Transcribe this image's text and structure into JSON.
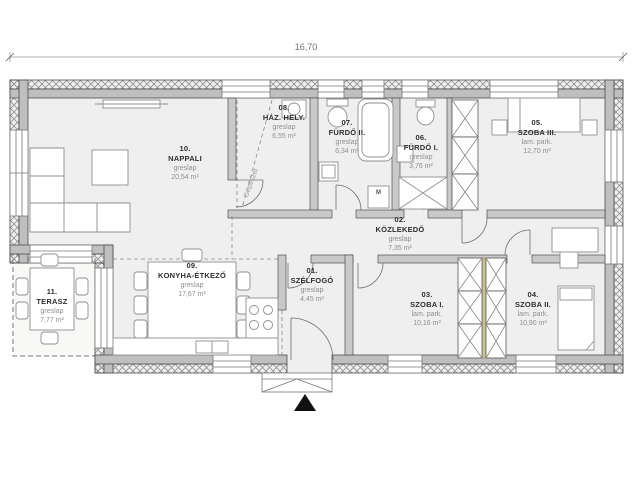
{
  "dimensions": {
    "total_width": "16,70"
  },
  "annotations": {
    "mechanical": "Gépészet",
    "washing_machine": "M"
  },
  "rooms": [
    {
      "number": "01.",
      "name": "SZÉLFOGÓ",
      "material": "greslap",
      "area": "4,45 m²"
    },
    {
      "number": "02.",
      "name": "KÖZLEKEDŐ",
      "material": "greslap",
      "area": "7,35 m²"
    },
    {
      "number": "03.",
      "name": "SZOBA I.",
      "material": "lam. park.",
      "area": "10,16 m²"
    },
    {
      "number": "04.",
      "name": "SZOBA II.",
      "material": "lam. park.",
      "area": "10,90 m²"
    },
    {
      "number": "05.",
      "name": "SZOBA III.",
      "material": "lam. park.",
      "area": "12,70 m²"
    },
    {
      "number": "06.",
      "name": "FÜRDŐ I.",
      "material": "greslap",
      "area": "3,76 m²"
    },
    {
      "number": "07.",
      "name": "FÜRDŐ II.",
      "material": "greslap",
      "area": "6,34 m²"
    },
    {
      "number": "08.",
      "name": "HÁZ. HELY.",
      "material": "greslap",
      "area": "6,55 m²"
    },
    {
      "number": "09.",
      "name": "KONYHA-ÉTKEZŐ",
      "material": "greslap",
      "area": "17,67 m²"
    },
    {
      "number": "10.",
      "name": "NAPPALI",
      "material": "greslap",
      "area": "20,54 m²"
    },
    {
      "number": "11.",
      "name": "TERASZ",
      "material": "greslap",
      "area": "7,77 m²"
    }
  ],
  "colors": {
    "wall_fill": "#bfbfbf",
    "wall_edge": "#4d4d4d",
    "floor": "#efefef",
    "wardrobe_divider": "#cfc08a",
    "text_dark": "#2e2e2e",
    "text_muted": "#8f8f8f"
  }
}
